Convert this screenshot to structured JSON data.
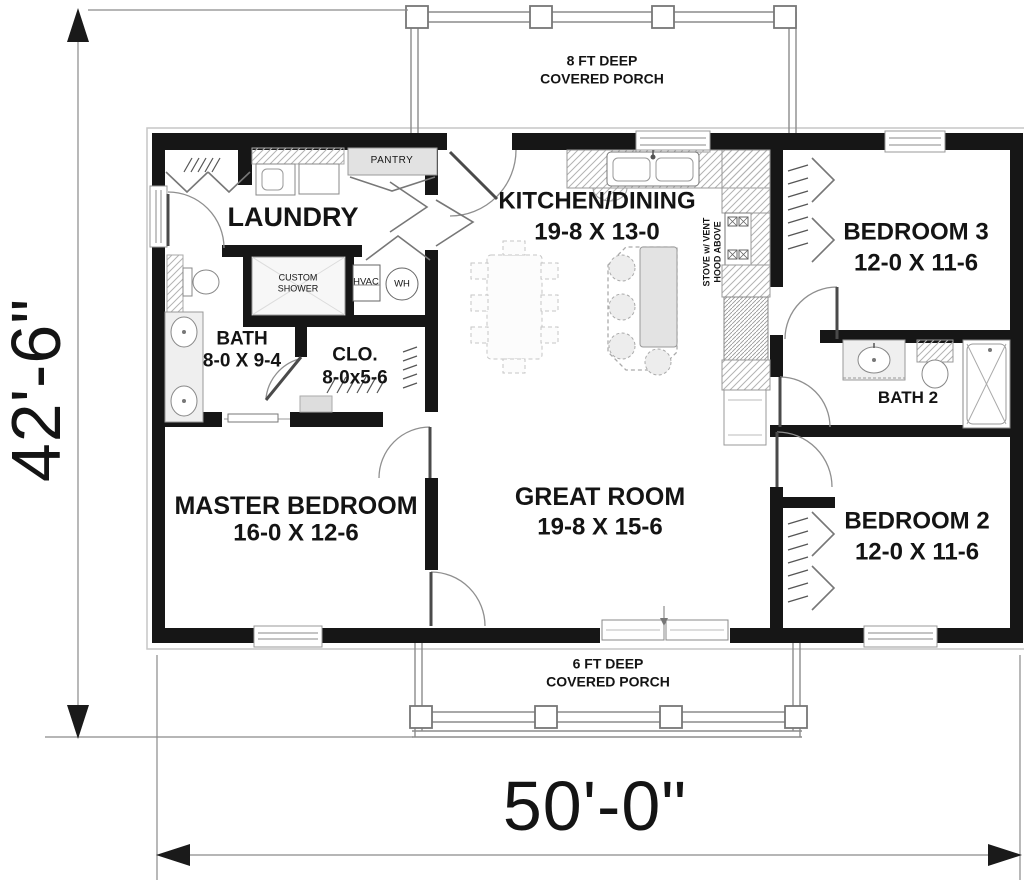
{
  "dimensions": {
    "width": "50'-0\"",
    "depth": "42'-6\""
  },
  "porches": {
    "top": {
      "line1": "8 FT DEEP",
      "line2": "COVERED PORCH"
    },
    "bottom": {
      "line1": "6 FT DEEP",
      "line2": "COVERED PORCH"
    }
  },
  "rooms": {
    "laundry": {
      "name": "LAUNDRY"
    },
    "kitchen_dining": {
      "name": "KITCHEN/DINING",
      "dims": "19-8 X 13-0"
    },
    "bedroom3": {
      "name": "BEDROOM 3",
      "dims": "12-0 X 11-6"
    },
    "bath": {
      "name": "BATH",
      "dims": "8-0 X 9-4"
    },
    "closet": {
      "name": "CLO.",
      "dims": "8-0x5-6"
    },
    "bath2": {
      "name": "BATH 2"
    },
    "master_bedroom": {
      "name": "MASTER BEDROOM",
      "dims": "16-0 X 12-6"
    },
    "great_room": {
      "name": "GREAT ROOM",
      "dims": "19-8 X 15-6"
    },
    "bedroom2": {
      "name": "BEDROOM 2",
      "dims": "12-0 X 11-6"
    }
  },
  "features": {
    "pantry": "PANTRY",
    "custom_shower": "CUSTOM SHOWER",
    "hvac": "HVAC",
    "water_heater": "WH",
    "stove_note": "STOVE w/ VENT HOOD ABOVE"
  },
  "colors": {
    "wall": "#161616",
    "line_gray": "#8c8c8c",
    "fill_light": "#e4e4e4"
  }
}
